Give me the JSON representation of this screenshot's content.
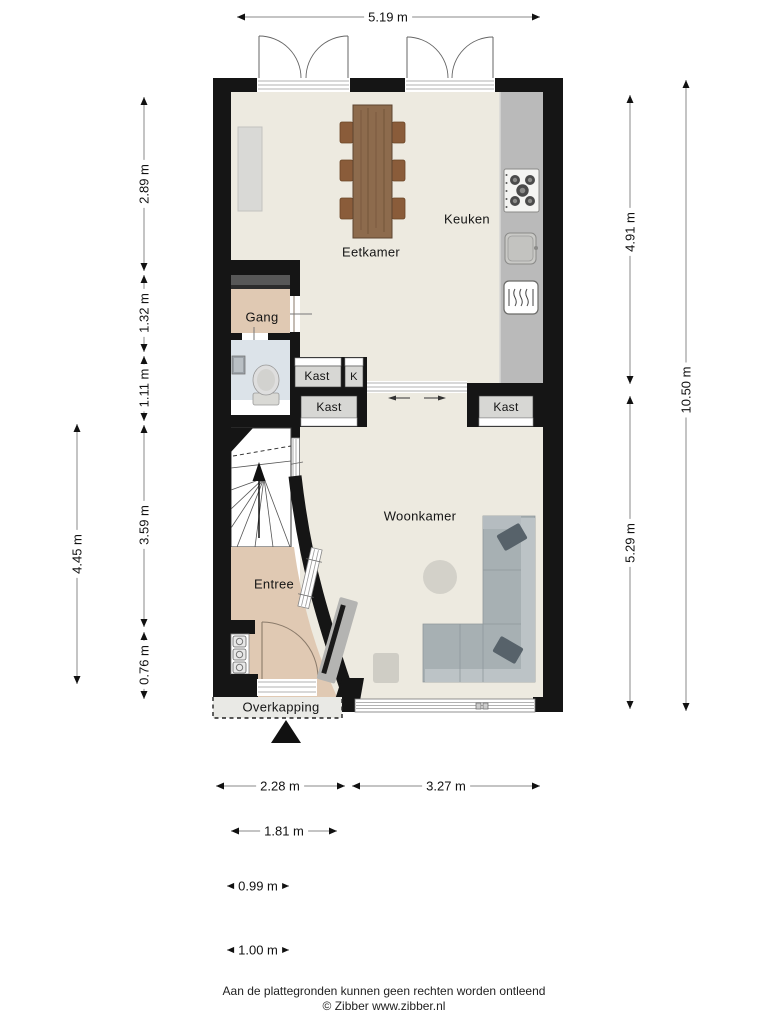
{
  "colors": {
    "wall": "#151515",
    "floor_main": "#edeae0",
    "floor_hall": "#e0c9b3",
    "floor_toilet": "#dce3e9",
    "closet_floor": "#d7d7d4",
    "counter": "#bababa",
    "sofa": "#a7b0b3",
    "sofa_cushion": "#57626a",
    "wood": "#8d6b4d"
  },
  "rooms": {
    "keuken": "Keuken",
    "eetkamer": "Eetkamer",
    "gang": "Gang",
    "woonkamer": "Woonkamer",
    "entree": "Entree",
    "overkapping": "Overkapping",
    "kast_top": "Kast",
    "kast_small": "K",
    "kast_mid": "Kast",
    "kast_right": "Kast"
  },
  "dimensions": {
    "top": [
      {
        "label": "5.19 m"
      }
    ],
    "left_outer": [
      {
        "label": "4.45 m"
      }
    ],
    "left_inner": [
      {
        "label": "2.89 m"
      },
      {
        "label": "1.32 m"
      },
      {
        "label": "1.11 m"
      },
      {
        "label": "3.59 m"
      },
      {
        "label": "0.76 m"
      }
    ],
    "right_inner": [
      {
        "label": "4.91 m"
      },
      {
        "label": "5.29 m"
      }
    ],
    "right_outer": [
      {
        "label": "10.50 m"
      }
    ],
    "bottom": [
      {
        "label": "2.28 m"
      },
      {
        "label": "3.27 m"
      },
      {
        "label": "1.81 m"
      },
      {
        "label": "0.99 m"
      },
      {
        "label": "1.00 m"
      }
    ]
  },
  "icons": {
    "north_arrow": "triangle-up",
    "stove": "five-burner-hob",
    "sink": "kitchen-sink",
    "heater": "radiator",
    "toilet": "toilet",
    "stairs": "winder-stairs-up",
    "meters": "utility-meters",
    "sliding_door": "double-arrow"
  },
  "footer": {
    "disclaimer": "Aan de plattegronden kunnen geen rechten worden ontleend",
    "credit": "© Zibber www.zibber.nl"
  }
}
